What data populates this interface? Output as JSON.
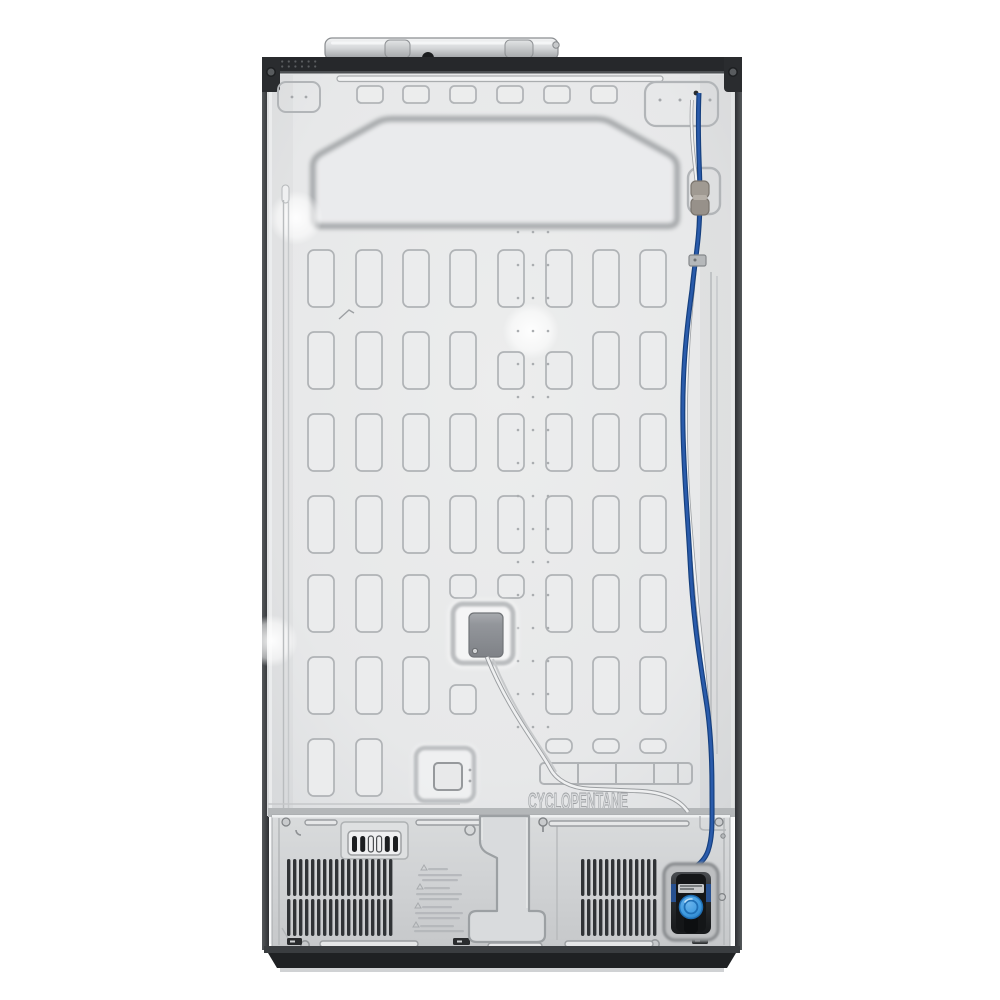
{
  "photo": {
    "subject": "refrigerator back panel product photo",
    "embossed_label": "CYCLOPENTANE",
    "colors": {
      "background": "#ffffff",
      "panel_gray": "#e9eaeb",
      "panel_edge": "#dcdee0",
      "emboss_stroke": "#b0b3b6",
      "deep_emboss_stroke": "#9da0a3",
      "trim_black": "#26282b",
      "bottom_plate_gray": "#d3d5d7",
      "vent_slat_dark": "#303336",
      "water_line_blue": "#1d4d9b",
      "valve_knob_blue": "#3f9be0",
      "valve_body_black": "#141618",
      "fitting_brass_gray": "#a09a92"
    }
  }
}
